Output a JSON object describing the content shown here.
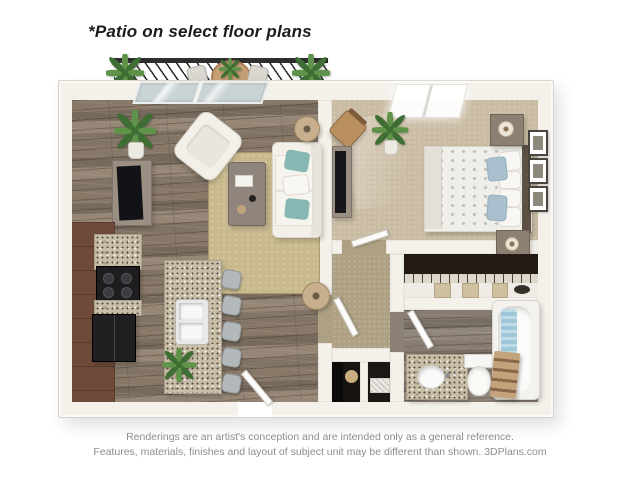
{
  "header": {
    "note": "*Patio on select floor plans"
  },
  "footer": {
    "line1": "Renderings are an artist's conception and are intended only as a general reference.",
    "line2": "Features, materials, finishes and layout of subject unit may be different than shown. 3DPlans.com"
  },
  "floorplan": {
    "style": "3D top-down apartment rendering",
    "areas": [
      "patio",
      "living-room",
      "kitchen",
      "bedroom",
      "hallway",
      "closet",
      "bathroom",
      "laundry-closets"
    ],
    "colors": {
      "text": "#1c1c1c",
      "muted_text": "#8d8d8d",
      "wall": "#f4f1eb",
      "wall_edge": "#d9d3ca",
      "wood_base": "#8f8172",
      "bath_wood": "#8a8076",
      "carpet_bedroom": "#cabca3",
      "carpet_hall": "#ada083",
      "rug": "#c9ba8e",
      "granite": "#c8bea8",
      "cabinet": "#6e4a38",
      "appliance": "#1e1e20",
      "white_furniture": "#f2f0e9",
      "teal_pillow": "#86b7b2",
      "blue_pillow": "#a9c0ce",
      "railing": "#2e2e2e",
      "plant": "#5f9349",
      "plant_dark": "#3e6e33",
      "glass": "#c9d3d5",
      "tub_towel": "#9cc8d8",
      "lamp": "#c7af8e",
      "closet_dark": "#241c14",
      "headboard": "#5d5146",
      "nightstand": "#8d7f71",
      "table_wood": "#8f857c",
      "patio_table": "#c8a078"
    }
  }
}
